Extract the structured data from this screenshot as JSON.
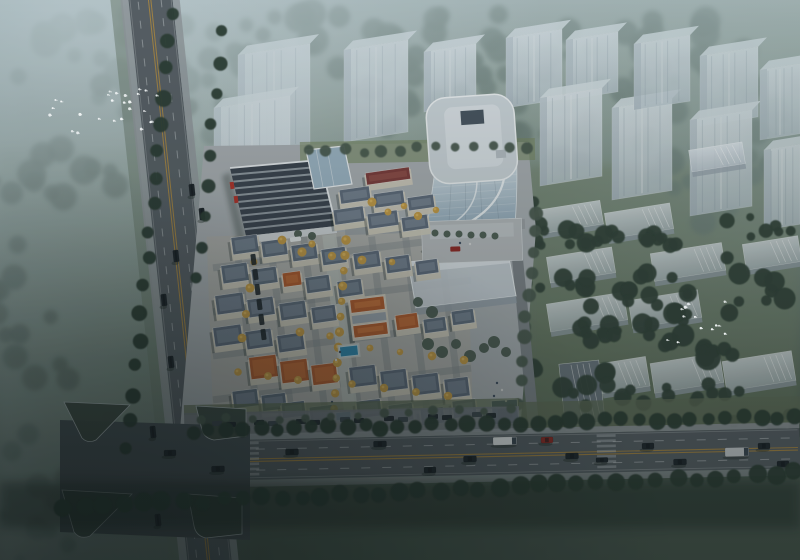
{
  "scene": {
    "type": "architectural-aerial-rendering",
    "description": "Dusk aerial rendering of a mixed-use development: curved glass office tower with rounded rooftop, retail center with dark striped roof and red accents, European-style low-rise village with slate and terracotta mansard roofs, ghosted white residential massing blocks among dark trees, misty woodland with flocks of white birds, a tilted boulevard on the left and a main arterial road with traffic at the bottom.",
    "palette": {
      "tree_hazy": "#5e7168",
      "tree_mid": "#49594e",
      "tree_dark": "#334239",
      "tree_road": "#2c3a31",
      "tree_yellow": "#c49a45",
      "tree_yellow_hi": "#e0b65c",
      "grass_left": "#7c8c80",
      "grass_right": "#6d7c60",
      "grass_island": "#3b4741",
      "ghost_face": "#ccd5dd",
      "ghost_top": "#e7edf2",
      "ghost_shade": "#9fabb8",
      "slab_face": "#cfd6dd",
      "slab_front": "#97a2ac",
      "slab_dark": "#6b7681",
      "glass_hi": "#c9d6de",
      "glass_lo": "#8099ab",
      "tower_roof": "#ccd4d9",
      "tower_roof_inner": "#dbe1e5",
      "skylight": "#46525e",
      "pavement": "#a9aeb2",
      "plaza": "#b6babd",
      "village_ground": "#b2afa5",
      "street": "#83898e",
      "axis": "#b9bdb9",
      "road": "#565d63",
      "road_dark": "#454d52",
      "sidewalk": "#90969b",
      "curb": "#c6cacc",
      "lane_yellow": "#b58b3c",
      "lane_white": "#ced2d5",
      "roof_slate": "#5e6a7a",
      "roof_slate_hi": "#8e99a7",
      "roof_orange": "#b15a2c",
      "roof_orange_hi": "#d07a40",
      "roof_maroon": "#7c3a38",
      "roof_maroon_hi": "#a05a52",
      "wall": "#cfc9bb",
      "retail_roof": "#39414c",
      "retail_stripe": "#aeb6bd",
      "red_accent": "#b03028",
      "atrium": "#9db4c4",
      "pool": "#2e86ad",
      "pool_edge": "#bfd8e2",
      "entrance_blue": "#2b3f63",
      "entrance_inner": "#16243c",
      "car_dark": "#1d2329",
      "car_red": "#8f2722",
      "truck_white": "#e6e9ea",
      "truck_grey": "#c9cccf",
      "bird": "#f4f7f8",
      "shadow": "#17211d",
      "white_edge": "#eef1f3"
    },
    "trees_hazy": [
      [
        120,
        58,
        118,
        44,
        24,
        7,
        9
      ],
      [
        295,
        42,
        110,
        36,
        20,
        7,
        9
      ],
      [
        470,
        46,
        115,
        34,
        20,
        6,
        9
      ],
      [
        655,
        58,
        125,
        45,
        22,
        7,
        9
      ],
      [
        770,
        120,
        55,
        60,
        14,
        6,
        8
      ],
      [
        200,
        118,
        90,
        40,
        16,
        6,
        8
      ],
      [
        420,
        108,
        78,
        30,
        13,
        5,
        7
      ],
      [
        600,
        128,
        88,
        36,
        15,
        6,
        8
      ],
      [
        718,
        182,
        68,
        42,
        13,
        6,
        8
      ],
      [
        520,
        80,
        40,
        26,
        8,
        5,
        6
      ],
      [
        640,
        92,
        40,
        26,
        8,
        5,
        6
      ]
    ],
    "trees_left": [
      [
        58,
        200,
        68,
        58,
        13,
        6,
        9
      ],
      [
        36,
        330,
        58,
        68,
        12,
        6,
        9
      ],
      [
        84,
        462,
        78,
        58,
        12,
        6,
        9
      ],
      [
        24,
        540,
        58,
        28,
        8,
        5,
        8
      ],
      [
        152,
        94,
        56,
        33,
        9,
        5,
        7
      ]
    ],
    "trees_dark": [
      [
        575,
        237,
        44,
        11,
        9,
        5,
        5
      ],
      [
        650,
        241,
        40,
        11,
        8,
        5,
        5
      ],
      [
        560,
        284,
        40,
        11,
        8,
        5,
        5
      ],
      [
        662,
        284,
        50,
        13,
        9,
        5,
        5
      ],
      [
        640,
        312,
        55,
        16,
        10,
        5,
        6
      ],
      [
        575,
        334,
        45,
        11,
        8,
        4,
        5
      ],
      [
        560,
        380,
        58,
        14,
        9,
        5,
        6
      ],
      [
        700,
        344,
        58,
        28,
        11,
        6,
        7
      ],
      [
        748,
        282,
        48,
        36,
        9,
        5,
        7
      ],
      [
        770,
        420,
        40,
        18,
        7,
        5,
        6
      ],
      [
        608,
        398,
        40,
        12,
        7,
        4,
        5
      ],
      [
        700,
        392,
        50,
        12,
        8,
        4,
        5
      ],
      [
        758,
        228,
        40,
        12,
        7,
        4,
        5
      ],
      [
        536,
        225,
        14,
        30,
        6,
        4,
        5
      ]
    ],
    "trees_site": [
      [
        466,
        338,
        44,
        18,
        10,
        4,
        5
      ],
      [
        508,
        330,
        24,
        12,
        6,
        4,
        4
      ],
      [
        226,
        232,
        14,
        7,
        4,
        3,
        3
      ]
    ],
    "rows_road": [
      [
        172,
        15,
        128,
        448,
        17,
        7
      ],
      [
        221,
        30,
        198,
        280,
        9,
        6
      ],
      [
        192,
        431,
        795,
        417,
        36,
        7
      ],
      [
        64,
        508,
        795,
        473,
        38,
        8
      ]
    ],
    "rows_mid": [
      [
        202,
        421,
        512,
        409,
        13,
        4
      ],
      [
        537,
        212,
        516,
        424,
        11,
        6
      ],
      [
        308,
        152,
        528,
        146,
        13,
        5
      ]
    ],
    "site_trees": [
      [
        435,
        233,
        3.5
      ],
      [
        447,
        234,
        3.5
      ],
      [
        459,
        234,
        3.5
      ],
      [
        471,
        235,
        3.5
      ],
      [
        483,
        235,
        3.5
      ],
      [
        495,
        236,
        3.5
      ],
      [
        428,
        344,
        6
      ],
      [
        442,
        352,
        6
      ],
      [
        456,
        344,
        5
      ],
      [
        470,
        356,
        6
      ],
      [
        484,
        348,
        5
      ],
      [
        494,
        342,
        6
      ],
      [
        506,
        352,
        5
      ],
      [
        418,
        302,
        5
      ],
      [
        432,
        312,
        6
      ],
      [
        298,
        234,
        4
      ],
      [
        312,
        236,
        4
      ]
    ],
    "yellow_rows": [
      [
        346,
        240,
        333,
        424,
        13
      ]
    ],
    "yellow_trees": [
      [
        254,
        262
      ],
      [
        250,
        288
      ],
      [
        246,
        314
      ],
      [
        242,
        338
      ],
      [
        302,
        252
      ],
      [
        332,
        256
      ],
      [
        362,
        260
      ],
      [
        392,
        262
      ],
      [
        300,
        332
      ],
      [
        330,
        336
      ],
      [
        388,
        212
      ],
      [
        418,
        216
      ],
      [
        372,
        202
      ],
      [
        404,
        206
      ],
      [
        436,
        210
      ],
      [
        238,
        372
      ],
      [
        268,
        376
      ],
      [
        298,
        380
      ],
      [
        352,
        384
      ],
      [
        384,
        388
      ],
      [
        416,
        392
      ],
      [
        448,
        396
      ],
      [
        370,
        348
      ],
      [
        400,
        352
      ],
      [
        432,
        356
      ],
      [
        464,
        360
      ],
      [
        282,
        240
      ],
      [
        312,
        244
      ]
    ],
    "ghost_towers": [
      [
        238,
        55,
        72,
        100
      ],
      [
        214,
        108,
        76,
        130
      ],
      [
        344,
        50,
        64,
        92
      ],
      [
        424,
        52,
        52,
        60
      ],
      [
        506,
        38,
        56,
        70
      ],
      [
        566,
        40,
        52,
        60
      ],
      [
        540,
        98,
        62,
        88
      ],
      [
        612,
        108,
        60,
        92
      ],
      [
        634,
        44,
        56,
        66
      ],
      [
        700,
        56,
        58,
        70
      ],
      [
        690,
        120,
        62,
        96
      ],
      [
        760,
        70,
        40,
        70
      ],
      [
        764,
        150,
        36,
        80
      ]
    ],
    "ghost_slabs": [
      [
        540,
        205,
        62,
        24,
        -9,
        0
      ],
      [
        606,
        208,
        66,
        26,
        -9,
        0
      ],
      [
        548,
        252,
        66,
        26,
        -9,
        0
      ],
      [
        652,
        248,
        72,
        28,
        -9,
        0
      ],
      [
        548,
        298,
        78,
        28,
        -9,
        0
      ],
      [
        630,
        295,
        70,
        28,
        -9,
        0
      ],
      [
        600,
        360,
        48,
        30,
        -9,
        0
      ],
      [
        652,
        358,
        70,
        30,
        -9,
        0
      ],
      [
        724,
        356,
        70,
        30,
        -9,
        0
      ],
      [
        744,
        240,
        56,
        26,
        -9,
        0
      ],
      [
        690,
        146,
        54,
        22,
        -9,
        0
      ],
      [
        562,
        362,
        40,
        62,
        -6,
        1
      ]
    ],
    "houses": [
      [
        366,
        170,
        44,
        12,
        -8,
        "r"
      ],
      [
        340,
        188,
        30,
        14,
        -8,
        "g"
      ],
      [
        374,
        192,
        30,
        14,
        -8,
        "g"
      ],
      [
        408,
        196,
        26,
        13,
        -8,
        "g"
      ],
      [
        334,
        208,
        30,
        15,
        -8,
        "g"
      ],
      [
        368,
        212,
        30,
        15,
        -8,
        "g"
      ],
      [
        402,
        216,
        26,
        14,
        -8,
        "g"
      ],
      [
        232,
        236,
        26,
        17,
        -8,
        "g"
      ],
      [
        262,
        240,
        25,
        16,
        -8,
        "g"
      ],
      [
        292,
        244,
        25,
        16,
        -8,
        "g"
      ],
      [
        322,
        248,
        24,
        16,
        -8,
        "g"
      ],
      [
        354,
        252,
        26,
        16,
        -8,
        "g"
      ],
      [
        386,
        256,
        24,
        16,
        -8,
        "g"
      ],
      [
        416,
        260,
        22,
        14,
        -8,
        "g"
      ],
      [
        222,
        264,
        26,
        18,
        -8,
        "g"
      ],
      [
        252,
        268,
        25,
        16,
        -8,
        "g"
      ],
      [
        283,
        272,
        18,
        14,
        -8,
        "o"
      ],
      [
        306,
        276,
        24,
        16,
        -8,
        "g"
      ],
      [
        338,
        280,
        24,
        16,
        -8,
        "g"
      ],
      [
        216,
        294,
        28,
        19,
        -8,
        "g"
      ],
      [
        248,
        298,
        26,
        18,
        -8,
        "g"
      ],
      [
        280,
        302,
        26,
        17,
        -8,
        "g"
      ],
      [
        312,
        306,
        24,
        16,
        -8,
        "g"
      ],
      [
        396,
        314,
        22,
        15,
        -8,
        "o"
      ],
      [
        424,
        318,
        22,
        14,
        -8,
        "g"
      ],
      [
        452,
        310,
        22,
        14,
        -8,
        "g"
      ],
      [
        214,
        326,
        28,
        19,
        -8,
        "g"
      ],
      [
        246,
        330,
        26,
        18,
        -8,
        "g"
      ],
      [
        278,
        334,
        26,
        17,
        -8,
        "g"
      ],
      [
        250,
        356,
        27,
        22,
        -7,
        "o"
      ],
      [
        281,
        360,
        27,
        22,
        -7,
        "o"
      ],
      [
        312,
        364,
        25,
        20,
        -7,
        "o"
      ],
      [
        350,
        366,
        26,
        20,
        -7,
        "g"
      ],
      [
        381,
        370,
        26,
        20,
        -7,
        "g"
      ],
      [
        413,
        374,
        26,
        20,
        -7,
        "g"
      ],
      [
        445,
        378,
        24,
        19,
        -7,
        "g"
      ],
      [
        233,
        390,
        25,
        17,
        -7,
        "g"
      ],
      [
        262,
        394,
        24,
        16,
        -7,
        "g"
      ],
      [
        282,
        402,
        23,
        15,
        -7,
        "g"
      ],
      [
        310,
        406,
        23,
        15,
        -7,
        "g"
      ],
      [
        357,
        400,
        24,
        17,
        -7,
        "g"
      ],
      [
        389,
        404,
        24,
        17,
        -7,
        "g"
      ],
      [
        421,
        408,
        23,
        16,
        -7,
        "g"
      ],
      [
        453,
        400,
        23,
        17,
        -7,
        "g"
      ]
    ],
    "chateau": {
      "x": 352,
      "y": 298,
      "w": 34,
      "h": 38,
      "rot": -7
    },
    "retail_corners": [
      [
        230,
        168
      ],
      [
        320,
        160
      ],
      [
        336,
        226
      ],
      [
        246,
        236
      ]
    ],
    "retail_stripes": 9,
    "vehicles_main": [
      [
        218,
        469,
        13,
        6,
        "car_dark"
      ],
      [
        292,
        452,
        13,
        6,
        "car_dark"
      ],
      [
        380,
        444,
        13,
        6,
        "car_dark"
      ],
      [
        430,
        470,
        12,
        6,
        "car_dark"
      ],
      [
        470,
        459,
        13,
        6,
        "car_dark"
      ],
      [
        505,
        441,
        24,
        8,
        "truck_white"
      ],
      [
        547,
        440,
        12,
        6,
        "car_red"
      ],
      [
        572,
        456,
        13,
        6,
        "car_dark"
      ],
      [
        602,
        460,
        12,
        5,
        "car_dark"
      ],
      [
        648,
        446,
        12,
        6,
        "car_dark"
      ],
      [
        680,
        462,
        13,
        6,
        "car_dark"
      ],
      [
        737,
        452,
        24,
        9,
        "truck_grey"
      ],
      [
        764,
        446,
        12,
        6,
        "car_dark"
      ],
      [
        783,
        464,
        12,
        6,
        "car_dark"
      ],
      [
        170,
        453,
        12,
        6,
        "car_dark"
      ]
    ],
    "vehicles_left": [
      [
        192,
        190
      ],
      [
        202,
        214
      ],
      [
        176,
        256
      ],
      [
        164,
        300
      ],
      [
        171,
        362
      ],
      [
        153,
        432
      ],
      [
        158,
        520
      ]
    ],
    "parked_main": [
      [
        212,
        421
      ],
      [
        226,
        422
      ],
      [
        254,
        420
      ],
      [
        268,
        421
      ],
      [
        296,
        419
      ],
      [
        310,
        420
      ],
      [
        340,
        417
      ],
      [
        354,
        418
      ],
      [
        384,
        416
      ],
      [
        398,
        417
      ],
      [
        428,
        414
      ],
      [
        442,
        415
      ],
      [
        472,
        412
      ],
      [
        486,
        413
      ]
    ],
    "parked_site": [
      [
        251,
        254
      ],
      [
        253,
        269
      ],
      [
        255,
        284
      ],
      [
        257,
        299
      ],
      [
        259,
        314
      ],
      [
        261,
        329
      ]
    ],
    "pools": [
      [
        340,
        346,
        18,
        10,
        -6
      ],
      [
        336,
        412,
        15,
        8,
        -6
      ]
    ],
    "people": [
      [
        497,
        383
      ],
      [
        502,
        390
      ],
      [
        494,
        396
      ],
      [
        506,
        401
      ],
      [
        499,
        408
      ],
      [
        489,
        412
      ],
      [
        460,
        243
      ],
      [
        470,
        244
      ],
      [
        340,
        352
      ],
      [
        336,
        360
      ],
      [
        332,
        402
      ]
    ],
    "bird_flocks": [
      [
        105,
        112,
        58,
        26,
        26
      ],
      [
        697,
        322,
        30,
        24,
        13
      ]
    ]
  }
}
